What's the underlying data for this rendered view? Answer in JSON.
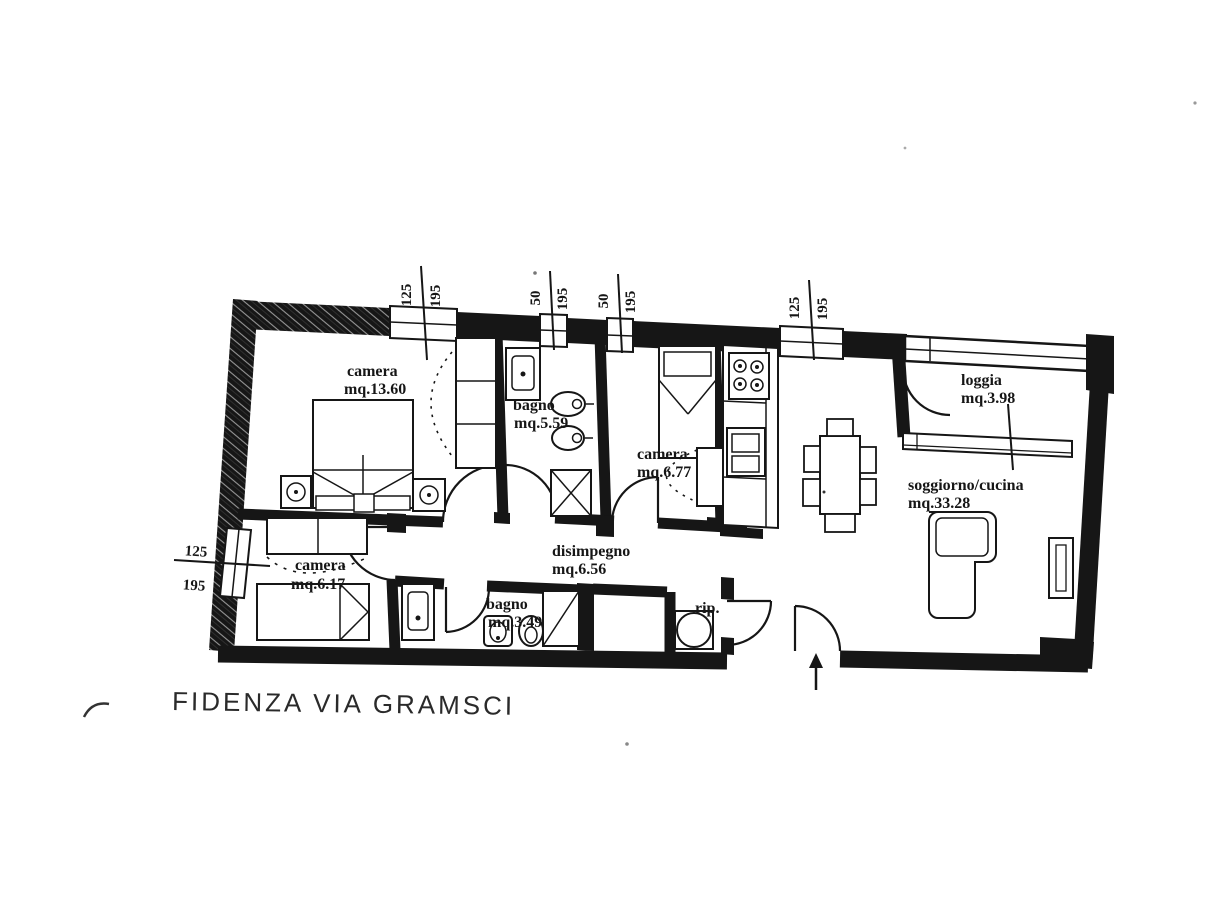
{
  "document": {
    "title_caption": "FIDENZA VIA GRAMSCI"
  },
  "rooms": [
    {
      "id": "camera-grande",
      "name": "camera",
      "area": "mq.13.60"
    },
    {
      "id": "bagno-grande",
      "name": "bagno",
      "area": "mq.5.59"
    },
    {
      "id": "camera-media",
      "name": "camera",
      "area": "mq.6.77"
    },
    {
      "id": "loggia",
      "name": "loggia",
      "area": "mq.3.98"
    },
    {
      "id": "soggiorno-cucina",
      "name": "soggiorno/cucina",
      "area": "mq.33.28"
    },
    {
      "id": "camera-piccola",
      "name": "camera",
      "area": "mq.6.17"
    },
    {
      "id": "disimpegno",
      "name": "disimpegno",
      "area": "mq.6.56"
    },
    {
      "id": "bagno-piccolo",
      "name": "bagno",
      "area": "mq.3.49"
    },
    {
      "id": "ripostiglio",
      "name": "rip.",
      "area": ""
    }
  ],
  "window_dimensions": {
    "top": [
      {
        "width_cm": "125",
        "height_cm": "195"
      },
      {
        "width_cm": "50",
        "height_cm": "195"
      },
      {
        "width_cm": "50",
        "height_cm": "195"
      },
      {
        "width_cm": "125",
        "height_cm": "195"
      }
    ],
    "left": {
      "width_cm": "125",
      "height_cm": "195"
    }
  },
  "colors": {
    "ink": "#161616",
    "paper": "#ffffff"
  }
}
